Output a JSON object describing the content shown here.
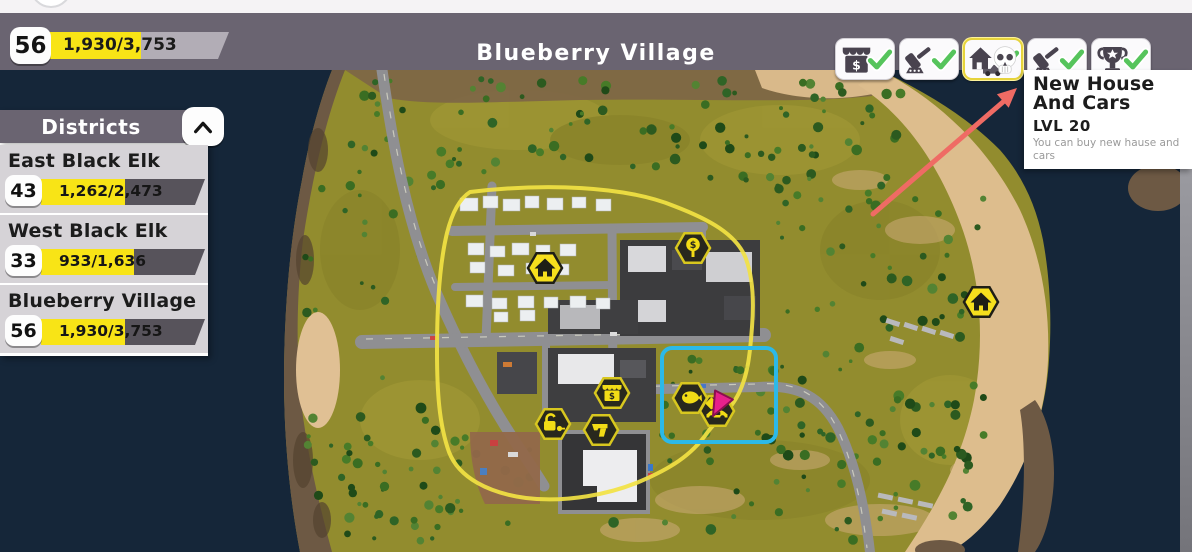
{
  "hud": {
    "player_level": "56",
    "xp_progress": {
      "text": "1,930/3,753",
      "percent": 51
    },
    "location_title": "Blueberry Village",
    "unlock_buttons": [
      {
        "label": "Market",
        "icon": "market-stall-icon",
        "completed": true,
        "highlighted": false
      },
      {
        "label": "Auction",
        "icon": "gavel-icon",
        "completed": true,
        "highlighted": false
      },
      {
        "label": "New House And Cars",
        "icon": "house-and-car-icon",
        "completed": true,
        "highlighted": true
      },
      {
        "label": "Auction",
        "icon": "gavel-icon",
        "completed": true,
        "highlighted": false
      },
      {
        "label": "Trophy",
        "icon": "trophy-icon",
        "completed": true,
        "highlighted": false
      }
    ]
  },
  "tooltip": {
    "title": "New House And Cars",
    "level": "LVL 20",
    "description": "You can buy new hause and cars"
  },
  "districts_panel": {
    "title": "Districts",
    "collapse_icon": "chevron-up-icon",
    "districts": [
      {
        "name": "East Black Elk",
        "level": "43",
        "progress_text": "1,262/2,473",
        "percent": 51
      },
      {
        "name": "West Black Elk",
        "level": "33",
        "progress_text": "933/1,636",
        "percent": 57
      },
      {
        "name": "Blueberry Village",
        "level": "56",
        "progress_text": "1,930/3,753",
        "percent": 51
      }
    ]
  },
  "map": {
    "region_name": "Blueberry Village",
    "markers": [
      {
        "icon": "house-icon",
        "style": "yellow",
        "x": 545,
        "y": 268
      },
      {
        "icon": "price-sign-icon",
        "style": "dark",
        "x": 693,
        "y": 248
      },
      {
        "icon": "market-stall-icon",
        "style": "dark",
        "x": 612,
        "y": 393
      },
      {
        "icon": "unlock-key-icon",
        "style": "dark",
        "x": 553,
        "y": 424
      },
      {
        "icon": "gun-icon",
        "style": "dark",
        "x": 601,
        "y": 430
      },
      {
        "icon": "fish-icon",
        "style": "dark",
        "x": 690,
        "y": 398
      },
      {
        "icon": "car-dealer-icon",
        "style": "dark",
        "x": 717,
        "y": 411
      },
      {
        "icon": "house-icon",
        "style": "yellow",
        "x": 981,
        "y": 302
      }
    ],
    "selection_box": {
      "x": 662,
      "y": 348,
      "width": 114,
      "height": 94,
      "color": "#2cb9e8"
    },
    "district_border_color": "#f2e243",
    "hex_yellow": "#f6df1d",
    "hex_dark_fill": "#28281d",
    "hex_dark_stroke": "#d8c71f",
    "annotation_arrow": {
      "from": [
        873,
        214
      ],
      "to": [
        1003,
        102
      ],
      "color": "#ef6b64"
    },
    "marker_arrow_color": "#e6218b"
  },
  "cursor": {
    "icon": "skull-cursor-icon",
    "x": 1003,
    "y": 58
  }
}
